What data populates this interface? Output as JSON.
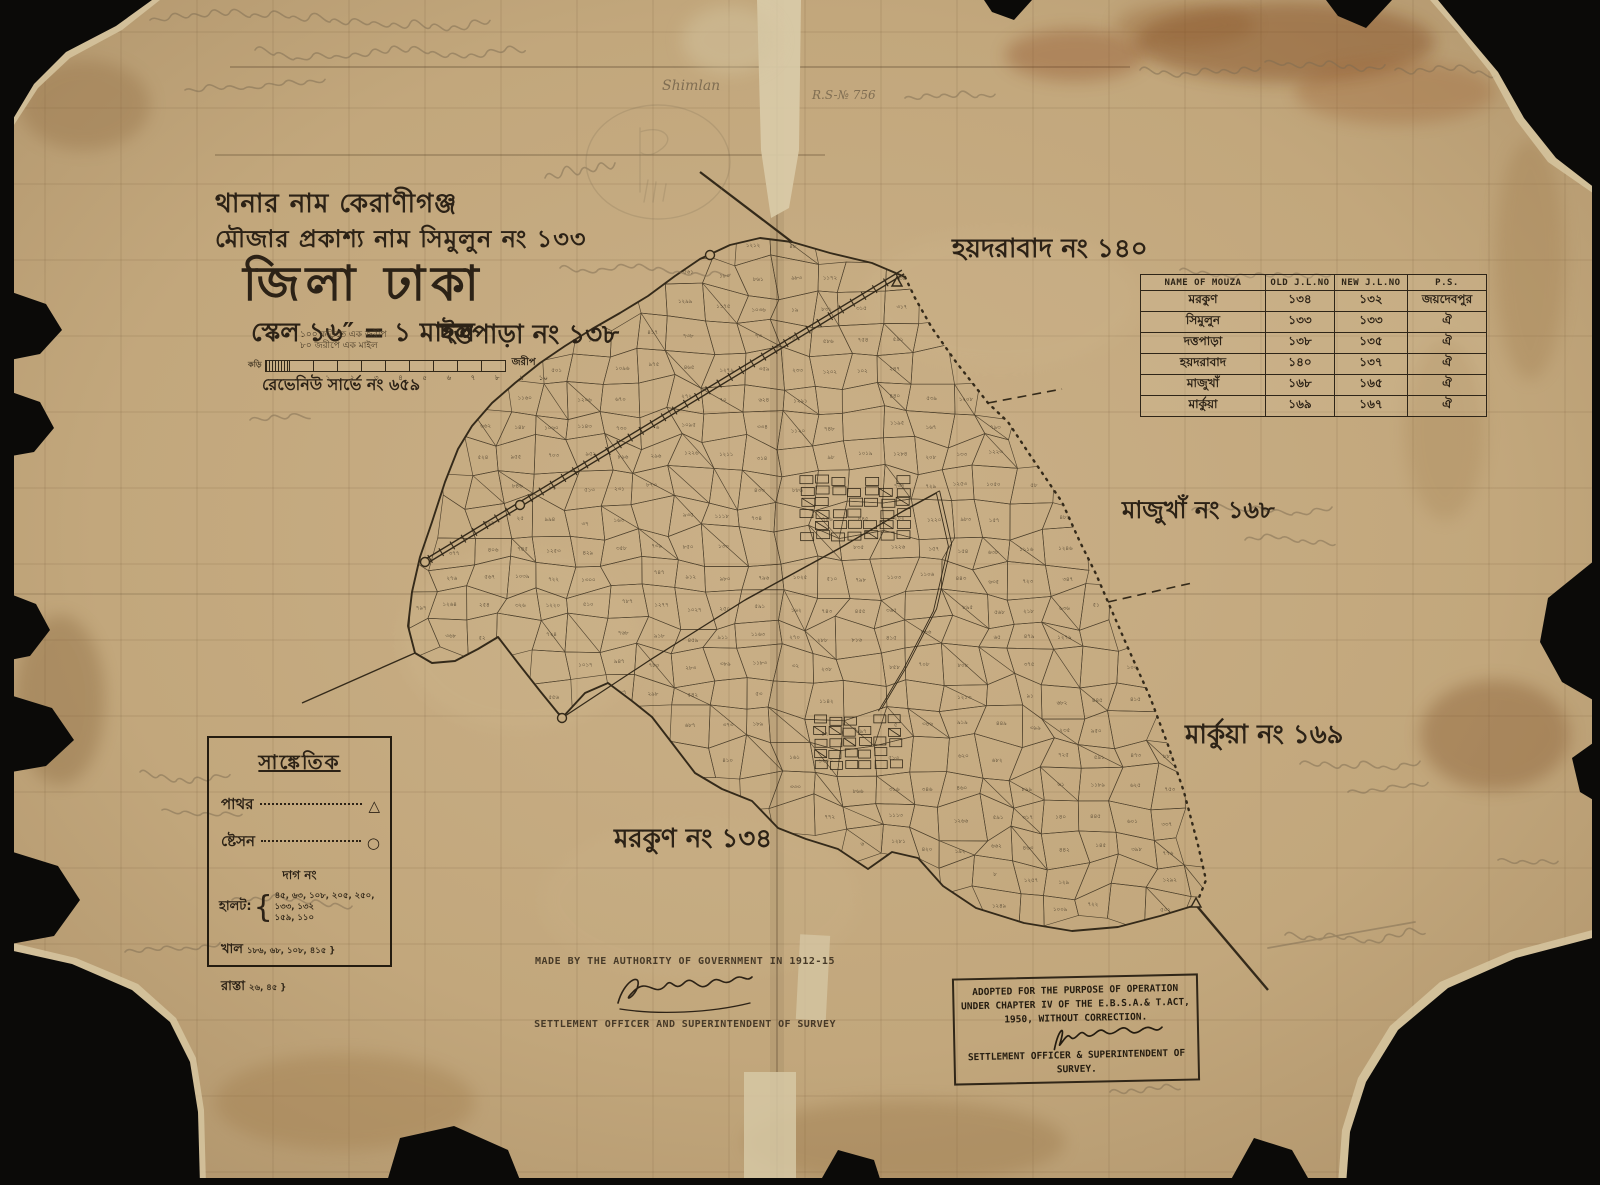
{
  "title_block": {
    "thana_line": "থানার নাম কেরাণীগঞ্জ",
    "mouza_line": "মৌজার প্রকাশ্য নাম  সিমুলুন নং ১৩৩",
    "district_line": "জিলা ঢাকা",
    "scale_line": "স্কেল ১৬″ = ১ মাইল"
  },
  "scale_bar": {
    "top_label_1": "১০০ কড়িতে এক জরীপ",
    "top_label_2": "৮০ জরীপে এক মাইল",
    "left_label": "কড়ি",
    "right_label": "জরীপ",
    "tick_labels": [
      "১",
      "২",
      "৩",
      "৪",
      "৫",
      "৬",
      "৭",
      "৮",
      "৯",
      "১০"
    ]
  },
  "revenue_note": "রেভেনিউ সার্ভে নং ৬৫৯",
  "adjacent_labels": {
    "dattapara": "দত্তপাড়া নং ১৩৮",
    "hyderabad": "হয়দরাবাদ নং ১৪০",
    "majukha": "মাজুখাঁ নং ১৬৮",
    "markua": "মার্কুয়া নং ১৬৯",
    "morkun": "মরকুণ নং ১৩৪"
  },
  "table": {
    "headers": [
      "NAME OF MOUZA",
      "OLD J.L.NO",
      "NEW J.L.NO",
      "P.S."
    ],
    "rows": [
      [
        "মরকুণ",
        "১৩৪",
        "১৩২",
        "জয়দেবপুর"
      ],
      [
        "সিমুলুন",
        "১৩৩",
        "১৩৩",
        "ঐ"
      ],
      [
        "দত্তপাড়া",
        "১৩৮",
        "১৩৫",
        "ঐ"
      ],
      [
        "হয়দরাবাদ",
        "১৪০",
        "১৩৭",
        "ঐ"
      ],
      [
        "মাজুখাঁ",
        "১৬৮",
        "১৬৫",
        "ঐ"
      ],
      [
        "মার্কুয়া",
        "১৬৯",
        "১৬৭",
        "ঐ"
      ]
    ]
  },
  "legend": {
    "title": "সাঙ্কেতিক",
    "items": [
      {
        "label": "পাথর",
        "symbol": "△"
      },
      {
        "label": "ষ্টেসন",
        "symbol": "○"
      }
    ],
    "dag_heading": "দাগ নং",
    "halot_label": "হালট:",
    "halot_numbers_line1": "৪৫, ৬৩, ১০৮, ২০৫, ২৫০, ১৩৩, ১৩২",
    "halot_numbers_line2": "১৫৯, ১১০",
    "khal_label": "খাল",
    "khal_numbers": "১৮৬, ৬৮, ১০৮,  ৪১৫ }",
    "rasta_label": "রাস্তা",
    "rasta_numbers": "২৬, ৪৫ }"
  },
  "footer": {
    "authority_line": "MADE BY THE AUTHORITY OF GOVERNMENT IN 1912-15",
    "officer_line": "SETTLEMENT OFFICER AND SUPERINTENDENT OF SURVEY"
  },
  "stamp": {
    "line1": "ADOPTED FOR THE PURPOSE OF OPERATION",
    "line2": "UNDER CHAPTER IV OF THE E.B.S.A.& T.ACT,",
    "line3": "1950, WITHOUT CORRECTION.",
    "signature": "K.A.Khan",
    "line4": "SETTLEMENT OFFICER & SUPERINTENDENT OF",
    "line5": "SURVEY."
  },
  "pencil_annotations": {
    "shimlan": "Shimlan",
    "rs_no": "R.S-№ 756"
  },
  "map_geometry": {
    "boundary": [
      [
        905,
        277
      ],
      [
        915,
        298
      ],
      [
        932,
        328
      ],
      [
        956,
        362
      ],
      [
        988,
        403
      ],
      [
        1008,
        422
      ],
      [
        1032,
        458
      ],
      [
        1062,
        502
      ],
      [
        1080,
        542
      ],
      [
        1096,
        574
      ],
      [
        1108,
        602
      ],
      [
        1128,
        648
      ],
      [
        1150,
        697
      ],
      [
        1168,
        745
      ],
      [
        1184,
        792
      ],
      [
        1198,
        845
      ],
      [
        1206,
        880
      ],
      [
        1196,
        905
      ],
      [
        1160,
        916
      ],
      [
        1118,
        927
      ],
      [
        1072,
        931
      ],
      [
        1024,
        923
      ],
      [
        976,
        908
      ],
      [
        943,
        886
      ],
      [
        918,
        858
      ],
      [
        892,
        852
      ],
      [
        868,
        869
      ],
      [
        838,
        849
      ],
      [
        806,
        839
      ],
      [
        778,
        828
      ],
      [
        752,
        801
      ],
      [
        722,
        789
      ],
      [
        695,
        773
      ],
      [
        672,
        743
      ],
      [
        652,
        717
      ],
      [
        632,
        701
      ],
      [
        608,
        683
      ],
      [
        585,
        693
      ],
      [
        562,
        718
      ],
      [
        540,
        691
      ],
      [
        518,
        663
      ],
      [
        498,
        637
      ],
      [
        478,
        649
      ],
      [
        455,
        661
      ],
      [
        432,
        663
      ],
      [
        415,
        653
      ],
      [
        408,
        626
      ],
      [
        412,
        592
      ],
      [
        420,
        557
      ],
      [
        432,
        522
      ],
      [
        445,
        482
      ],
      [
        458,
        449
      ],
      [
        472,
        426
      ],
      [
        492,
        403
      ],
      [
        515,
        383
      ],
      [
        540,
        363
      ],
      [
        565,
        346
      ],
      [
        592,
        329
      ],
      [
        620,
        313
      ],
      [
        648,
        296
      ],
      [
        675,
        276
      ],
      [
        700,
        259
      ],
      [
        730,
        245
      ],
      [
        760,
        238
      ],
      [
        792,
        242
      ],
      [
        830,
        253
      ],
      [
        872,
        263
      ]
    ],
    "dotted_count": 18,
    "railway": {
      "from": [
        425,
        562
      ],
      "to": [
        903,
        272
      ]
    },
    "roads": [
      [
        [
          565,
          716
        ],
        [
          650,
          660
        ],
        [
          745,
          600
        ],
        [
          840,
          548
        ],
        [
          905,
          510
        ],
        [
          938,
          492
        ]
      ],
      [
        [
          938,
          492
        ],
        [
          950,
          545
        ],
        [
          935,
          610
        ],
        [
          905,
          668
        ],
        [
          880,
          710
        ]
      ]
    ],
    "rays": [
      [
        792,
        242,
        700,
        172,
        2.2,
        0
      ],
      [
        988,
        403,
        1062,
        389,
        1.6,
        1
      ],
      [
        1108,
        602,
        1192,
        583,
        1.6,
        1
      ],
      [
        1196,
        905,
        1268,
        990,
        2.4,
        0
      ],
      [
        415,
        653,
        302,
        703,
        1.4,
        0
      ]
    ],
    "station_circles": [
      [
        425,
        562
      ],
      [
        520,
        505
      ],
      [
        562,
        718
      ],
      [
        710,
        255
      ]
    ],
    "stone_triangles": [
      [
        897,
        282
      ],
      [
        1196,
        903
      ]
    ],
    "clusters": [
      [
        855,
        508,
        7,
        6,
        16,
        11
      ],
      [
        858,
        742,
        6,
        5,
        15,
        11
      ]
    ]
  }
}
